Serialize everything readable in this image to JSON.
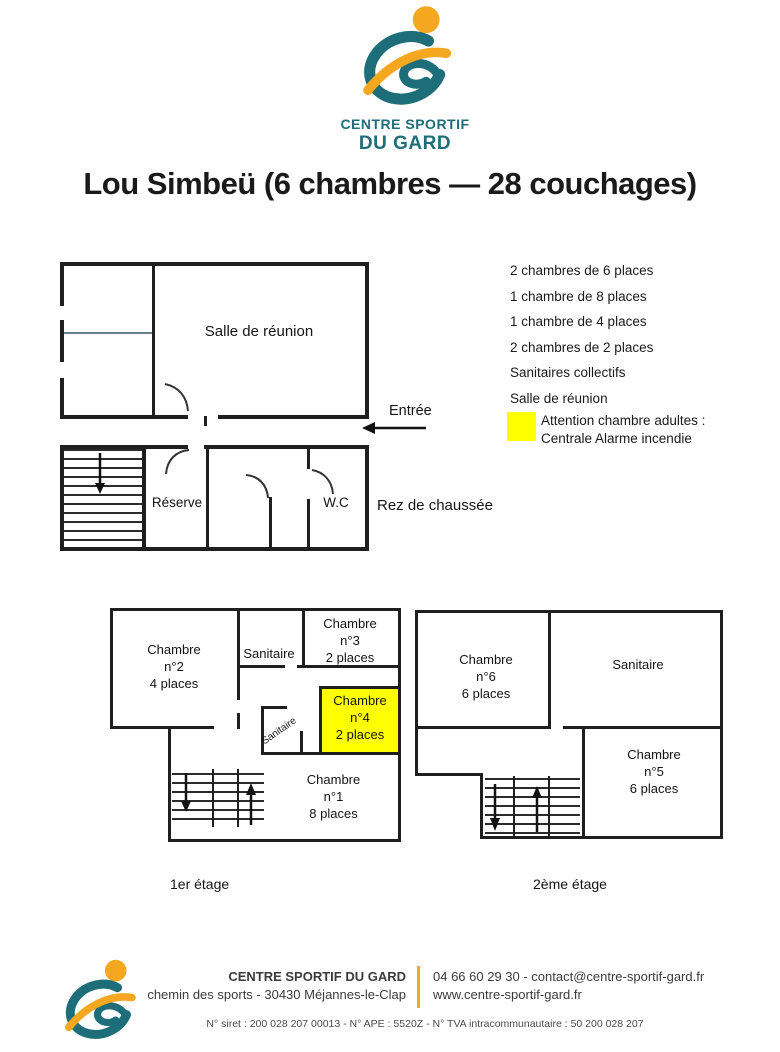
{
  "colors": {
    "teal": "#1d6e79",
    "orange": "#f4a71f",
    "highlight": "#ffff00",
    "wall": "#1f1f1f"
  },
  "logo": {
    "line1": "CENTRE SPORTIF",
    "line2": "DU GARD"
  },
  "title": "Lou Simbeü (6 chambres — 28 couchages)",
  "ground_floor": {
    "salle": "Salle de réunion",
    "entree": "Entrée",
    "reserve": "Réserve",
    "wc": "W.C",
    "floor_label": "Rez de chaussée"
  },
  "legend": {
    "items": [
      "2 chambres de 6 places",
      "1 chambre de 8 places",
      "1 chambre de 4 places",
      "2 chambres de 2 places",
      "Sanitaires collectifs",
      "Salle de réunion"
    ],
    "warning_line1": "Attention chambre adultes :",
    "warning_line2": "Centrale Alarme incendie"
  },
  "first_floor": {
    "floor_label": "1er étage",
    "chambre2": [
      "Chambre",
      "n°2",
      "4 places"
    ],
    "sanitaire": "Sanitaire",
    "chambre3": [
      "Chambre",
      "n°3",
      "2 places"
    ],
    "chambre4": [
      "Chambre",
      "n°4",
      "2 places"
    ],
    "sanitaire_small": "Sanitaire",
    "chambre1": [
      "Chambre",
      "n°1",
      "8 places"
    ]
  },
  "second_floor": {
    "floor_label": "2ème étage",
    "chambre6": [
      "Chambre",
      "n°6",
      "6 places"
    ],
    "sanitaire": "Sanitaire",
    "chambre5": [
      "Chambre",
      "n°5",
      "6 places"
    ]
  },
  "footer": {
    "name": "CENTRE SPORTIF DU GARD",
    "address": "chemin des sports - 30430 Méjannes-le-Clap",
    "phone_email": "04 66 60 29 30 - contact@centre-sportif-gard.fr",
    "website": "www.centre-sportif-gard.fr",
    "legal": "N° siret : 200 028 207 00013 - N° APE : 5520Z - N° TVA intracommunautaire : 50 200 028 207"
  }
}
